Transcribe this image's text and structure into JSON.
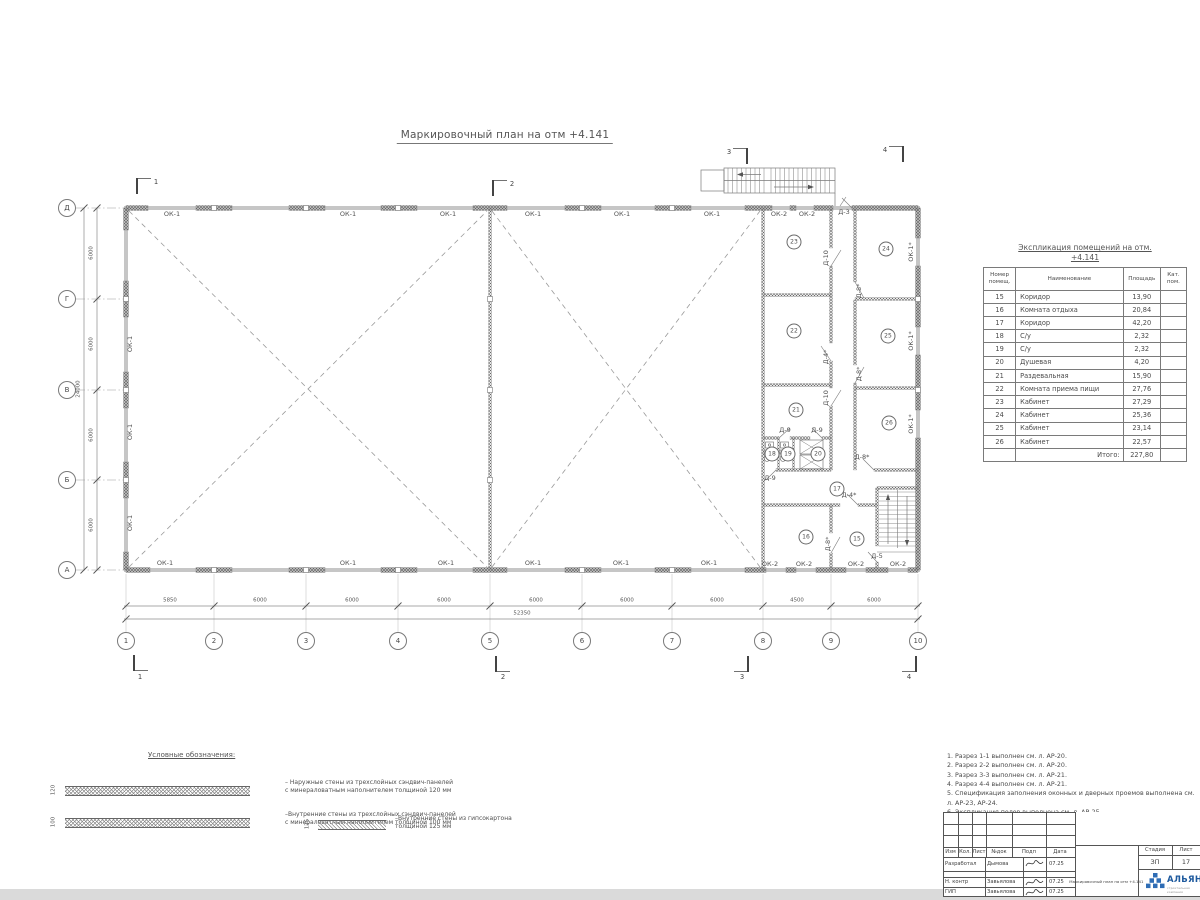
{
  "plan": {
    "title": "Маркировочный план на отм +4.141",
    "grid": {
      "cols": [
        {
          "n": "1",
          "x": 126
        },
        {
          "n": "2",
          "x": 214
        },
        {
          "n": "3",
          "x": 306
        },
        {
          "n": "4",
          "x": 398
        },
        {
          "n": "5",
          "x": 490
        },
        {
          "n": "6",
          "x": 582
        },
        {
          "n": "7",
          "x": 672
        },
        {
          "n": "8",
          "x": 763
        },
        {
          "n": "9",
          "x": 831
        },
        {
          "n": "10",
          "x": 918
        }
      ],
      "rows": [
        {
          "n": "Д",
          "y": 208
        },
        {
          "n": "Г",
          "y": 299
        },
        {
          "n": "В",
          "y": 390
        },
        {
          "n": "Б",
          "y": 480
        },
        {
          "n": "А",
          "y": 570
        }
      ],
      "dims_bottom": [
        {
          "v": "5850",
          "x": 170
        },
        {
          "v": "6000",
          "x": 260
        },
        {
          "v": "6000",
          "x": 352
        },
        {
          "v": "6000",
          "x": 444
        },
        {
          "v": "6000",
          "x": 536
        },
        {
          "v": "6000",
          "x": 627
        },
        {
          "v": "6000",
          "x": 717
        },
        {
          "v": "4500",
          "x": 797
        },
        {
          "v": "6000",
          "x": 874
        }
      ],
      "total_bottom": {
        "v": "52350",
        "x": 522,
        "y": 614
      },
      "dims_left": [
        {
          "v": "6000",
          "y": 253
        },
        {
          "v": "6000",
          "y": 344
        },
        {
          "v": "6000",
          "y": 435
        },
        {
          "v": "6000",
          "y": 525
        }
      ],
      "total_left": {
        "v": "24000",
        "x": 79,
        "y": 389
      }
    },
    "sections": [
      {
        "n": "1",
        "x": 156,
        "y": 182
      },
      {
        "n": "2",
        "x": 512,
        "y": 184
      },
      {
        "n": "3",
        "x": 729,
        "y": 152
      },
      {
        "n": "4",
        "x": 885,
        "y": 150
      },
      {
        "n": "1",
        "x": 140,
        "y": 677
      },
      {
        "n": "2",
        "x": 503,
        "y": 677
      },
      {
        "n": "3",
        "x": 742,
        "y": 677
      },
      {
        "n": "4",
        "x": 909,
        "y": 677
      }
    ],
    "labels": [
      {
        "t": "ОК-1",
        "x": 172,
        "y": 214
      },
      {
        "t": "ОК-1",
        "x": 348,
        "y": 214
      },
      {
        "t": "ОК-1",
        "x": 448,
        "y": 214
      },
      {
        "t": "ОК-1",
        "x": 533,
        "y": 214
      },
      {
        "t": "ОК-1",
        "x": 622,
        "y": 214
      },
      {
        "t": "ОК-1",
        "x": 712,
        "y": 214
      },
      {
        "t": "ОК-2",
        "x": 779,
        "y": 214
      },
      {
        "t": "ОК-2",
        "x": 807,
        "y": 214
      },
      {
        "t": "Д-3",
        "x": 844,
        "y": 212
      },
      {
        "t": "ОК-1",
        "x": 165,
        "y": 563
      },
      {
        "t": "ОК-1",
        "x": 348,
        "y": 563
      },
      {
        "t": "ОК-1",
        "x": 446,
        "y": 563
      },
      {
        "t": "ОК-1",
        "x": 533,
        "y": 563
      },
      {
        "t": "ОК-1",
        "x": 621,
        "y": 563
      },
      {
        "t": "ОК-1",
        "x": 709,
        "y": 563
      },
      {
        "t": "ОК-2",
        "x": 770,
        "y": 564
      },
      {
        "t": "ОК-2",
        "x": 804,
        "y": 564
      },
      {
        "t": "ОК-2",
        "x": 856,
        "y": 564
      },
      {
        "t": "ОК-2",
        "x": 898,
        "y": 564
      },
      {
        "t": "Д-5",
        "x": 877,
        "y": 556
      },
      {
        "t": "ОК-1",
        "x": 130,
        "y": 344,
        "r": 1
      },
      {
        "t": "ОК-1",
        "x": 130,
        "y": 432,
        "r": 1
      },
      {
        "t": "ОК-1",
        "x": 130,
        "y": 523,
        "r": 1
      },
      {
        "t": "ОК-1*",
        "x": 911,
        "y": 252,
        "r": 1
      },
      {
        "t": "ОК-1*",
        "x": 911,
        "y": 341,
        "r": 1
      },
      {
        "t": "ОК-1*",
        "x": 911,
        "y": 424,
        "r": 1
      },
      {
        "t": "Д-10",
        "x": 826,
        "y": 258,
        "r": 1
      },
      {
        "t": "Д-4*",
        "x": 826,
        "y": 357,
        "r": 1
      },
      {
        "t": "Д-10",
        "x": 826,
        "y": 398,
        "r": 1
      },
      {
        "t": "Д-8*",
        "x": 828,
        "y": 544,
        "r": 1
      },
      {
        "t": "Д-8*",
        "x": 859,
        "y": 291,
        "r": 1
      },
      {
        "t": "Д-8*",
        "x": 859,
        "y": 374,
        "r": 1
      },
      {
        "t": "Д-9",
        "x": 785,
        "y": 430
      },
      {
        "t": "Д-9",
        "x": 817,
        "y": 430
      },
      {
        "t": "Д-9",
        "x": 770,
        "y": 478
      },
      {
        "t": "Д-8*",
        "x": 862,
        "y": 457
      },
      {
        "t": "Д-4*",
        "x": 849,
        "y": 495
      }
    ],
    "rooms": [
      {
        "n": "15",
        "x": 857,
        "y": 539
      },
      {
        "n": "16",
        "x": 806,
        "y": 537
      },
      {
        "n": "17",
        "x": 837,
        "y": 489
      },
      {
        "n": "18",
        "x": 772,
        "y": 454
      },
      {
        "n": "19",
        "x": 788,
        "y": 454
      },
      {
        "n": "20",
        "x": 818,
        "y": 454
      },
      {
        "n": "21",
        "x": 796,
        "y": 410
      },
      {
        "n": "22",
        "x": 794,
        "y": 331
      },
      {
        "n": "23",
        "x": 794,
        "y": 242
      },
      {
        "n": "24",
        "x": 886,
        "y": 249
      },
      {
        "n": "25",
        "x": 888,
        "y": 336
      },
      {
        "n": "26",
        "x": 889,
        "y": 423
      }
    ]
  },
  "explication": {
    "title_line1": "Экспликация помещений на отм.",
    "title_line2": "+4.141",
    "headers": [
      "Номер помещ.",
      "Наименование",
      "Площадь",
      "Кат. пом."
    ],
    "rows": [
      [
        "15",
        "Коридор",
        "13,90",
        ""
      ],
      [
        "16",
        "Комната отдыха",
        "20,84",
        ""
      ],
      [
        "17",
        "Коридор",
        "42,20",
        ""
      ],
      [
        "18",
        "С/у",
        "2,32",
        ""
      ],
      [
        "19",
        "С/у",
        "2,32",
        ""
      ],
      [
        "20",
        "Душевая",
        "4,20",
        ""
      ],
      [
        "21",
        "Раздевальная",
        "15,90",
        ""
      ],
      [
        "22",
        "Комната приема пищи",
        "27,76",
        ""
      ],
      [
        "23",
        "Кабинет",
        "27,29",
        ""
      ],
      [
        "24",
        "Кабинет",
        "25,36",
        ""
      ],
      [
        "25",
        "Кабинет",
        "23,14",
        ""
      ],
      [
        "26",
        "Кабинет",
        "22,57",
        ""
      ]
    ],
    "total_label": "Итого:",
    "total_value": "227,80"
  },
  "legend": {
    "title": "Условные обозначения:",
    "items": [
      {
        "dim": "120",
        "text": "– Наружные стены из трехслойных сэндвич-панелей с минераловатным наполнителем толщиной 120 мм"
      },
      {
        "dim": "100",
        "text": "–Внутренние стены из трехслойных сэндвич-панелей с минераловатным наполнителем толщиной 100 мм"
      },
      {
        "dim": "125",
        "text": "–Внутренние стены из гипсокартона толщиной 125 мм"
      }
    ]
  },
  "notes": {
    "items": [
      "1. Разрез 1-1 выполнен см. л. АР-20.",
      "2. Разрез 2-2 выполнен см. л. АР-20.",
      "3. Разрез 3-3 выполнен см. л. АР-21.",
      "4. Разрез 4-4 выполнен см. л. АР-21.",
      "5. Спецификация заполнения оконных и дверных проемов выполнена см. л. АР-23, АР-24.",
      "6. Экспликация полов выполнена см. л. АР-25."
    ]
  },
  "titleblock": {
    "header_cols": [
      "Изм",
      "Кол.",
      "Лист",
      "№док",
      "Подп",
      "Дата"
    ],
    "rows": [
      {
        "role": "Разработал",
        "name": "Дымова",
        "date": "07.25"
      },
      {
        "role": "Н. контр",
        "name": "Завьялова",
        "date": "07.25"
      },
      {
        "role": "ГИП",
        "name": "Завьялова",
        "date": "07.25"
      }
    ],
    "doc_title": "Маркировочный план на отм +4.141",
    "stage_label": "Стадия",
    "stage_value": "ЗП",
    "sheet_label": "Лист",
    "sheet_value": "17",
    "logo_text": "АЛЬЯНС",
    "logo_sub": "строительная компания"
  },
  "colors": {
    "logo_blue": "#1e5a9e",
    "wall_dark": "#606060",
    "line": "#777777"
  }
}
